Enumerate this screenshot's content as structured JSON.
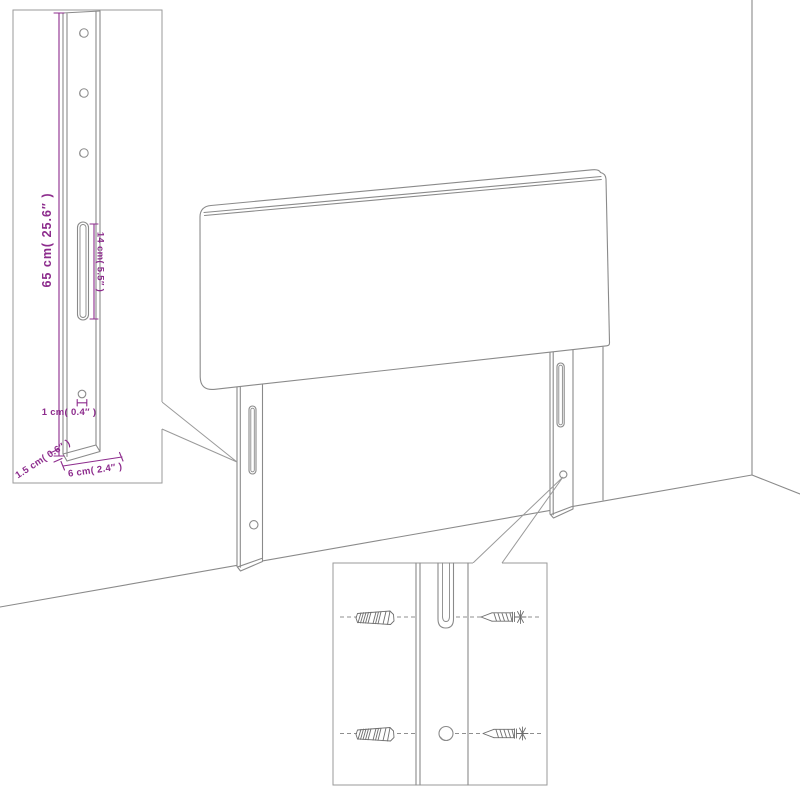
{
  "diagram": {
    "kind": "headboard-assembly-dimension-diagram",
    "colors": {
      "line": "#8a8a8a",
      "dimension": "#8d2c8d",
      "hardware": "#6e6e6e",
      "background": "#ffffff"
    },
    "leg_detail": {
      "dim_height": "65 cm( 25.6″ )",
      "dim_slot": "14 cm( 5.5″ )",
      "dim_hole": "1 cm( 0.4″ )",
      "dim_thickness": "1.5 cm( 0.6″ )",
      "dim_width": "6 cm( 2.4″ )"
    },
    "mounting_detail": {
      "parts": [
        "wall-anchor",
        "leg-slot",
        "leg-hole",
        "screw"
      ]
    }
  }
}
